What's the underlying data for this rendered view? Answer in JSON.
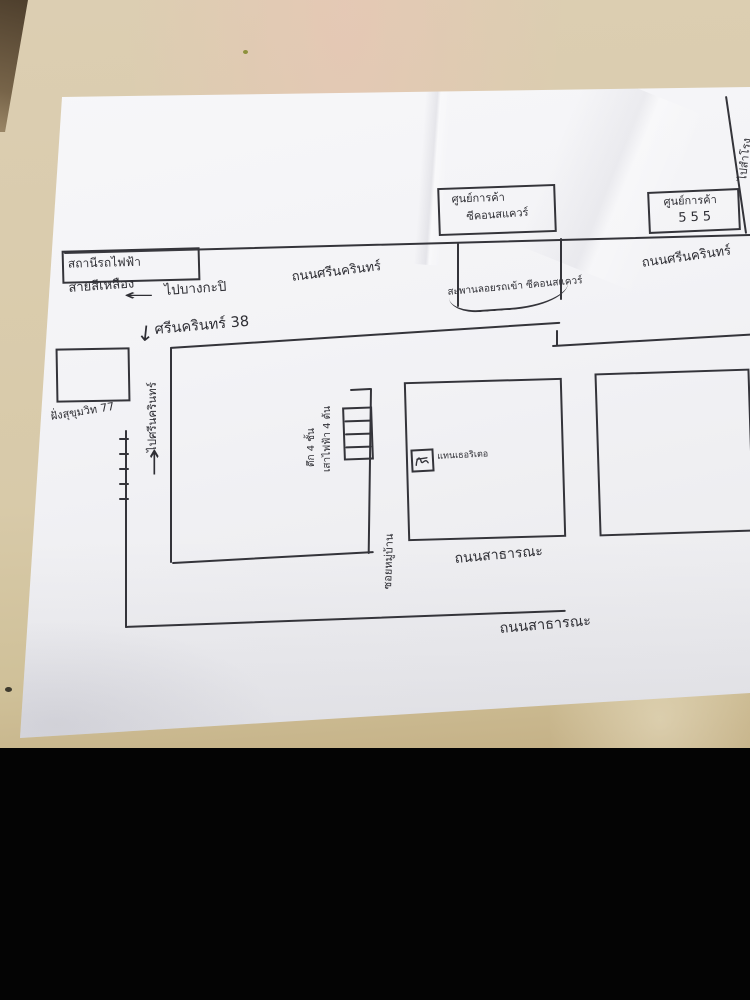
{
  "photo": {
    "colors": {
      "paper": "#f3f3f6",
      "table_beige": "#d8caa9",
      "ink": "#34343a",
      "black_bar": "#040404"
    }
  },
  "icons": {
    "arrow_left": "←",
    "arrow_down": "↓",
    "arrow_up": "↑"
  },
  "map": {
    "station": {
      "box_label": "สถานีรถไฟฟ้า",
      "line_label": "สายสีเหลือง"
    },
    "directions": {
      "to_bangkapi": "ไปบางกะปิ",
      "to_samrong": "ไปสำโรง",
      "to_srinakarin": "ไปศรีนครินทร์"
    },
    "roads": {
      "srinakarin_left": "ถนนศรีนครินทร์",
      "srinakarin_right": "ถนนศรีนครินทร์",
      "soi_38": "ศรีนครินทร์ 38",
      "village_soi": "ซอยหมู่บ้าน",
      "sukhumvit_77": "ฝั่งสุขุมวิท 77",
      "public_road_1": "ถนนสาธารณะ",
      "public_road_2": "ถนนสาธารณะ"
    },
    "buildings": {
      "seacon_line1": "ศูนย์การค้า",
      "seacon_line2": "ซีคอนสแควร์",
      "mall555_line1": "ศูนย์การค้า",
      "mall555_line2": "555"
    },
    "notes": {
      "ramp": "สะพานลอยรถเข้า ซีคอนสแควร์",
      "building_4floors": "ตึก 4 ชั้น",
      "poles": "เสาไฟฟ้า 4 ต้น",
      "marker": "แทนเธอริเตอ"
    }
  }
}
